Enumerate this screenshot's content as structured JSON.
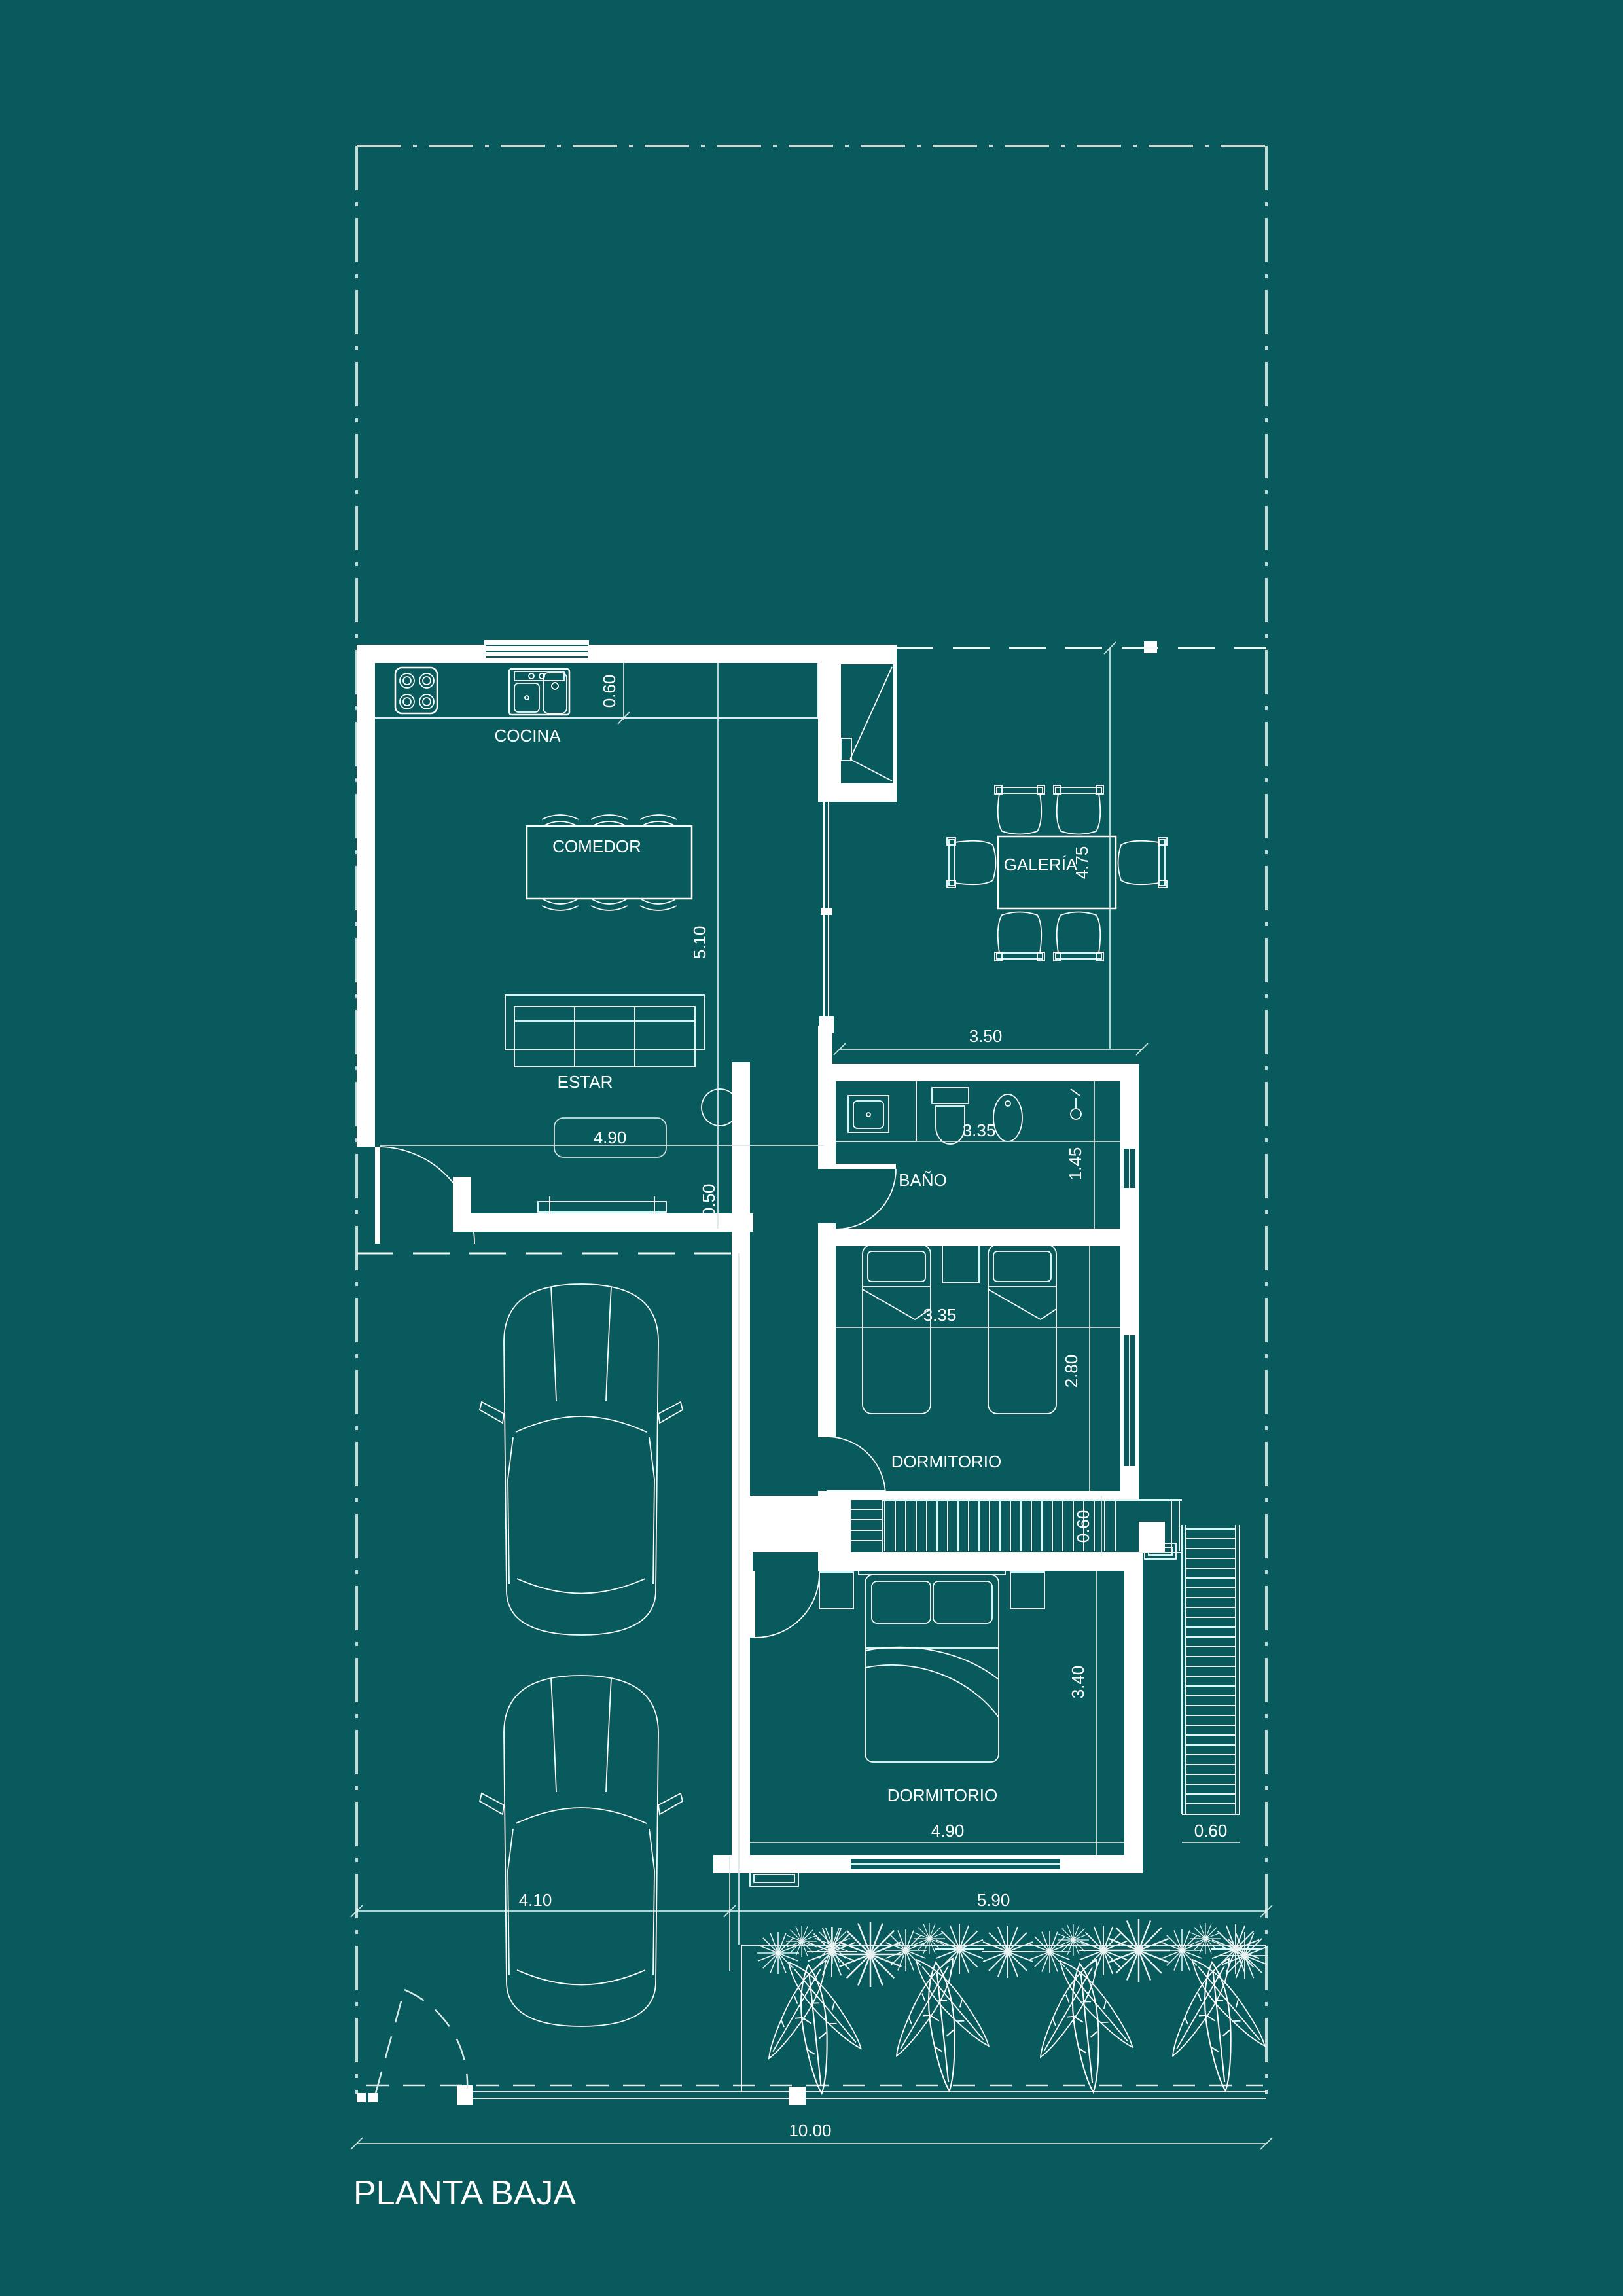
{
  "title": "PLANTA BAJA",
  "colors": {
    "background": "#085a5c",
    "lines": "#ffffff",
    "boundary": "#c6dbd8"
  },
  "rooms": {
    "kitchen": "COCINA",
    "dining": "COMEDOR",
    "living": "ESTAR",
    "gallery": "GALERÍA",
    "bathroom": "BAÑO",
    "bedroom1": "DORMITORIO",
    "bedroom2": "DORMITORIO"
  },
  "dimensions": {
    "kitchen_counter_depth": "0.60",
    "living_length": "5.10",
    "living_width": "4.90",
    "gallery_length": "4.75",
    "gallery_width": "3.50",
    "bath_width": "3.35",
    "bath_depth": "1.45",
    "hall_closet_depth": "0.50",
    "bedroom1_width": "3.35",
    "bedroom1_depth": "2.80",
    "deck_depth": "0.60",
    "bedroom2_depth": "3.40",
    "bedroom2_width": "4.90",
    "stair_width": "0.60",
    "garage_front_width": "4.10",
    "garden_front_width": "5.90",
    "lot_width": "10.00"
  }
}
